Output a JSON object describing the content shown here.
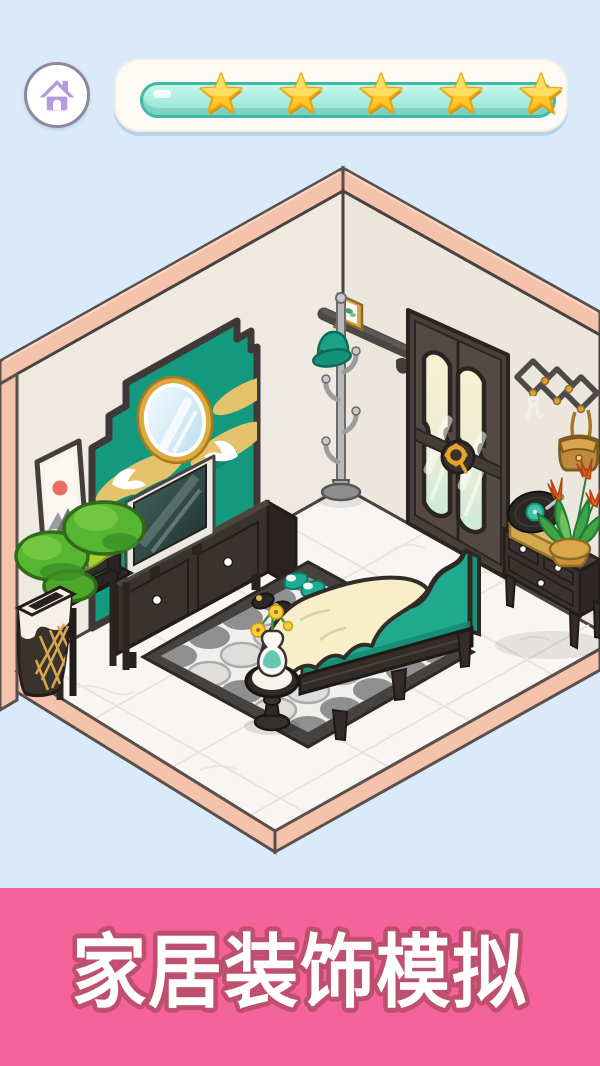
{
  "header": {
    "home_button": {
      "icon": "home-icon"
    },
    "star_bar": {
      "star_icon": "star-icon",
      "star_count": 5,
      "progress_percent": 100
    }
  },
  "banner": {
    "title": "家居装饰模拟"
  },
  "palette": {
    "background": "#D9EBFA",
    "banner_pink": "#F4639A",
    "banner_outline": "#BE4F6F",
    "banner_text": "#FFFFFF",
    "wall_cream": "#EFEAE1",
    "wall_cream_right": "#ECE7DD",
    "trim_pink": "#F5C3AB",
    "outline_dark": "#453D39",
    "floor_white": "#F8F6F2",
    "accent_teal": "#14997F",
    "sofa_teal": "#1FA98E",
    "blanket_cream": "#F7EFC9",
    "furniture_dark": "#3A322F",
    "gold": "#E5C36C",
    "mirror_gold": "#DFA93E",
    "star_gold": "#FFC72E",
    "progress_mint": "#A9ECDE",
    "progress_border": "#3FB9A7",
    "home_purple": "#B49BDC"
  },
  "scene": {
    "items": [
      "accent-wall-panel",
      "oval-mirror",
      "wall-scroll-painting",
      "crane-decals",
      "tv",
      "tv-stand",
      "bonsai-tree",
      "side-table",
      "trash-bin",
      "patterned-rug",
      "teal-slippers",
      "black-slippers",
      "pedestal-side-table",
      "flower-vase",
      "teal-sofa",
      "cream-blanket",
      "coat-rack",
      "teal-hat",
      "wall-shelf",
      "photo-frame",
      "double-door",
      "gold-door-handle",
      "accordion-wall-hook",
      "hanging-keys",
      "shoulder-bag",
      "dresser",
      "record-player",
      "potted-plant"
    ]
  }
}
